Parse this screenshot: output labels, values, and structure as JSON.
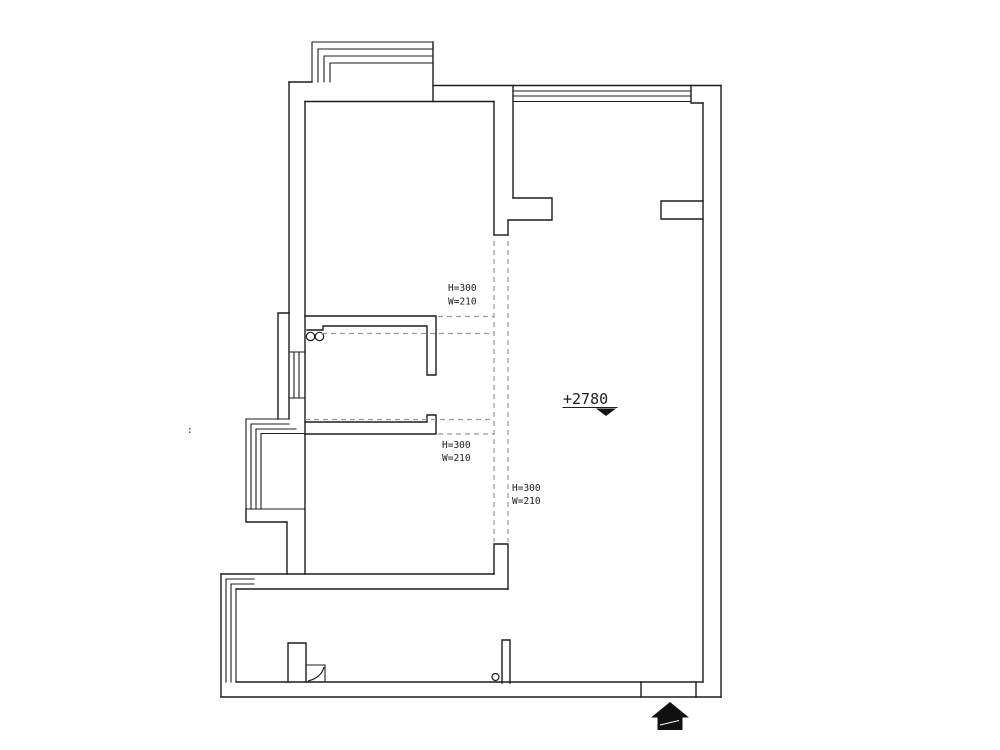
{
  "drawing_type": "residential-floor-plan",
  "level_marker": {
    "value": "+2780"
  },
  "beam_annotations": [
    {
      "height": "H=300",
      "width": "W=210"
    },
    {
      "height": "H=300",
      "width": "W=210"
    },
    {
      "height": "H=300",
      "width": "W=210"
    }
  ],
  "stray_mark": ":",
  "colors": {
    "wall_line": "#1c1c1c",
    "dashed_line": "#999999",
    "background": "#ffffff",
    "arrow_fill": "#111111",
    "text": "#1c1c1c"
  }
}
